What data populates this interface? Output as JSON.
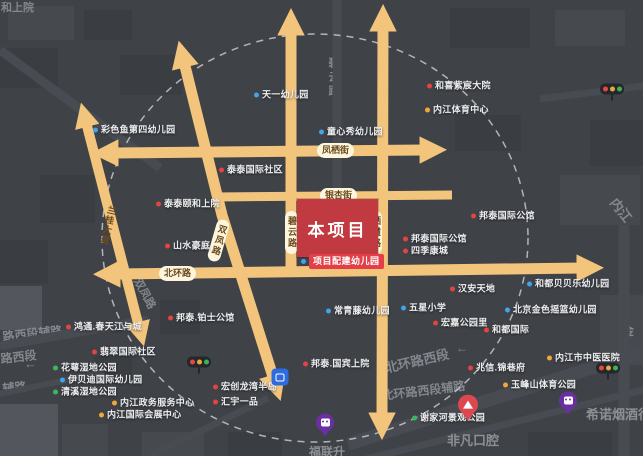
{
  "colors": {
    "background": "#3f4247",
    "road": "#f2c47c",
    "road_badge_bg": "#fdf6dd",
    "road_badge_text": "#6b4a1f",
    "project_block_red": "#c23a41",
    "project_badge_red": "#e33f48",
    "dashed_circle": "#ced2d7",
    "poi_text": "#edeef0",
    "street_text": "#90939a",
    "dots": {
      "blue": "#41a3ea",
      "red": "#e2453e",
      "yellow": "#efa93b",
      "green": "#3bb763"
    }
  },
  "project": {
    "block_label": "本项目",
    "kindergarten_badge": "项目配建幼儿园"
  },
  "road_badges": [
    {
      "text": "凤栖街",
      "orient": "h",
      "x": 317,
      "y": 143
    },
    {
      "text": "银杏街",
      "orient": "h",
      "x": 320,
      "y": 188
    },
    {
      "text": "北环路",
      "orient": "h",
      "x": 159,
      "y": 266
    },
    {
      "text": "碧云路",
      "orient": "v",
      "x": 285,
      "y": 211
    },
    {
      "text": "栖霞路",
      "orient": "v",
      "x": 369,
      "y": 211
    },
    {
      "text": "双凤路",
      "orient": "v",
      "x": 212,
      "y": 219,
      "rot": 16
    },
    {
      "text": "兰桂大道",
      "orient": "plain",
      "x": 103,
      "y": 205,
      "rot": 13
    }
  ],
  "street_names": [
    {
      "text": "和上院",
      "x": 1,
      "y": 3,
      "size": 11
    },
    {
      "text": "碧云路",
      "x": 327,
      "y": 57,
      "size": 11,
      "vertical": true
    },
    {
      "text": "双凤路",
      "x": 141,
      "y": 277,
      "size": 11,
      "rot": 62
    },
    {
      "text": "北环路西段",
      "x": 384,
      "y": 362,
      "size": 13,
      "rot": -13
    },
    {
      "text": "北环路西段辅路",
      "x": 381,
      "y": 390,
      "size": 12,
      "rot": -7
    },
    {
      "text": "路西段辅路",
      "x": 2,
      "y": 331,
      "size": 12,
      "rot": -6
    },
    {
      "text": "路西段",
      "x": 0,
      "y": 353,
      "size": 12,
      "rot": -6
    },
    {
      "text": "辅路",
      "x": 2,
      "y": 383,
      "size": 12,
      "rot": -6
    },
    {
      "text": "内江",
      "x": 618,
      "y": 196,
      "size": 13,
      "rot": 52
    },
    {
      "text": "金",
      "x": 622,
      "y": 325,
      "size": 12
    },
    {
      "text": "←",
      "x": 24,
      "y": 357,
      "size": 13,
      "kind": "arrow"
    },
    {
      "text": "←",
      "x": 456,
      "y": 342,
      "size": 12,
      "kind": "arrow"
    }
  ],
  "pois": [
    {
      "text": "天一幼儿园",
      "dot": "blue",
      "x": 254,
      "y": 95
    },
    {
      "text": "彩色鱼第四幼儿园",
      "dot": "blue",
      "x": 93,
      "y": 130
    },
    {
      "text": "童心秀幼儿园",
      "dot": "blue",
      "x": 319,
      "y": 132
    },
    {
      "text": "和喜紫宸大院",
      "dot": "red",
      "x": 427,
      "y": 86
    },
    {
      "text": "内江体育中心",
      "dot": "yellow",
      "x": 425,
      "y": 110
    },
    {
      "text": "泰泰国际社区",
      "dot": "red",
      "x": 219,
      "y": 170
    },
    {
      "text": "泰泰颐和上院",
      "dot": "red",
      "x": 156,
      "y": 204
    },
    {
      "text": "山水豪庭",
      "dot": "red",
      "x": 165,
      "y": 246
    },
    {
      "text": "邦泰国际公馆",
      "dot": "red",
      "x": 471,
      "y": 216
    },
    {
      "text": "邦泰国际公馆",
      "dot": "red",
      "x": 403,
      "y": 239
    },
    {
      "text": "四季康城",
      "dot": "red",
      "x": 403,
      "y": 251
    },
    {
      "text": "汉安天地",
      "dot": "red",
      "x": 450,
      "y": 289
    },
    {
      "text": "和都贝贝乐幼儿园",
      "dot": "blue",
      "x": 527,
      "y": 284
    },
    {
      "text": "五星小学",
      "dot": "blue",
      "x": 401,
      "y": 308
    },
    {
      "text": "北京金色摇篮幼儿园",
      "dot": "blue",
      "x": 505,
      "y": 310
    },
    {
      "text": "常青藤幼儿园",
      "dot": "blue",
      "x": 326,
      "y": 311
    },
    {
      "text": "宏嘉公园里",
      "dot": "red",
      "x": 433,
      "y": 323
    },
    {
      "text": "和都国际",
      "dot": "red",
      "x": 484,
      "y": 330
    },
    {
      "text": "内江市中医医院",
      "dot": "yellow",
      "x": 547,
      "y": 358
    },
    {
      "text": "兆信.锦巷府",
      "dot": "red",
      "x": 468,
      "y": 368
    },
    {
      "text": "玉峰山体育公园",
      "dot": "yellow",
      "x": 503,
      "y": 385
    },
    {
      "text": "谢家河景观公园",
      "dot": "green",
      "x": 412,
      "y": 418
    },
    {
      "text": "邦泰.铂士公馆",
      "dot": "red",
      "x": 168,
      "y": 318
    },
    {
      "text": "邦泰.国宾上院",
      "dot": "red",
      "x": 303,
      "y": 364
    },
    {
      "text": "宏创龙湾半岛",
      "dot": "red",
      "x": 213,
      "y": 387
    },
    {
      "text": "汇宇一品",
      "dot": "red",
      "x": 213,
      "y": 402
    },
    {
      "text": "鸿通.春天江与城",
      "dot": "red",
      "x": 66,
      "y": 327
    },
    {
      "text": "翡翠国际社区",
      "dot": "red",
      "x": 92,
      "y": 352
    },
    {
      "text": "花萼湿地公园",
      "dot": "green",
      "x": 53,
      "y": 368
    },
    {
      "text": "伊贝迪国际幼儿园",
      "dot": "blue",
      "x": 60,
      "y": 380
    },
    {
      "text": "清溪湿地公园",
      "dot": "green",
      "x": 53,
      "y": 392
    },
    {
      "text": "内江政务服务中心",
      "dot": "yellow",
      "x": 112,
      "y": 403
    },
    {
      "text": "内江国际会展中心",
      "dot": "yellow",
      "x": 99,
      "y": 415
    }
  ],
  "store_pois": [
    {
      "icon": "red-pin",
      "label": "非凡口腔",
      "x": 468,
      "y": 418,
      "label_x": 447,
      "label_y": 434,
      "label_size": 13
    },
    {
      "icon": "purple-pin",
      "label": "希诺烟酒行",
      "x": 568,
      "y": 403,
      "label_x": 586,
      "label_y": 408,
      "label_size": 13
    },
    {
      "icon": "purple-pin",
      "label": "福联升",
      "x": 325,
      "y": 425,
      "label_x": 309,
      "label_y": 446,
      "label_size": 12
    }
  ],
  "traffic_lights": [
    {
      "x": 612,
      "y": 92
    },
    {
      "x": 199,
      "y": 365
    },
    {
      "x": 608,
      "y": 371
    }
  ],
  "transit_stations": [
    {
      "x": 280,
      "y": 377
    }
  ]
}
